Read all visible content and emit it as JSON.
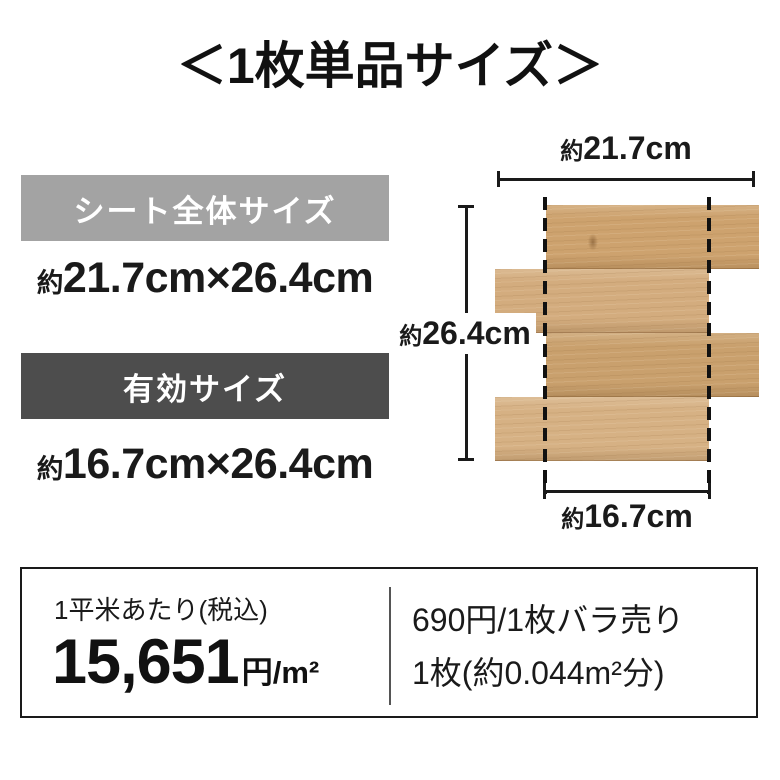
{
  "title": "＜1枚単品サイズ＞",
  "sheet_size": {
    "badge": "シート全体サイズ",
    "approx": "約",
    "value": "21.7cm×26.4cm"
  },
  "effective_size": {
    "badge": "有効サイズ",
    "approx": "約",
    "value": "16.7cm×26.4cm"
  },
  "diagram": {
    "width_approx": "約",
    "width_value": "21.7cm",
    "height_approx": "約",
    "height_value": "26.4cm",
    "effective_width_approx": "約",
    "effective_width_value": "16.7cm"
  },
  "price_box": {
    "per_sqm_caption": "1平米あたり(税込)",
    "per_sqm_amount": "15,651",
    "per_sqm_unit": "円/m²",
    "per_piece_line1": "690円/1枚バラ売り",
    "per_piece_line2": "1枚(約0.044m²分)"
  },
  "colors": {
    "sheet_badge_bg": "#a3a3a3",
    "effective_badge_bg": "#4d4d4d",
    "text": "#1a1a1a",
    "wood_base": "#cfa678"
  }
}
